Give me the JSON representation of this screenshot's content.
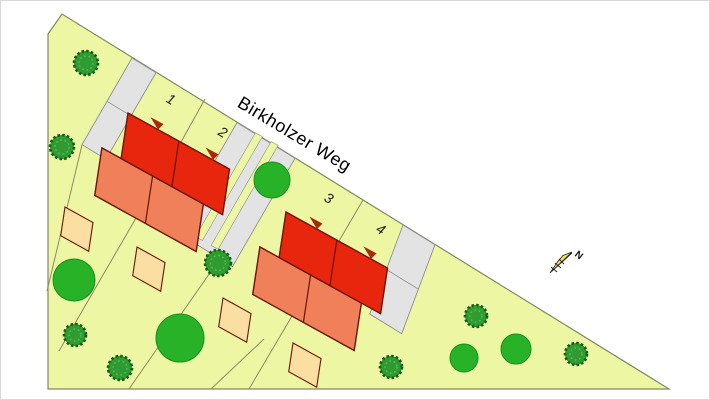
{
  "map": {
    "street": {
      "name": "Birkholzer Weg"
    },
    "plots": [
      {
        "label": "1"
      },
      {
        "label": "2"
      },
      {
        "label": "3"
      },
      {
        "label": "4"
      }
    ],
    "north": {
      "label": "N"
    },
    "colors": {
      "background": "#ffffff",
      "plot_green": "#edf6a3",
      "plot_border": "#85856a",
      "boundary_line": "#8b8b68",
      "driveway_gray": "#e3e3e3",
      "driveway_border": "#8f8f8f",
      "roof_red": "#e8260d",
      "house_salmon": "#f0805a",
      "terrace_peach": "#fbdfa2",
      "outline_dark": "#6b1400",
      "marker_red": "#a82808",
      "tree_green": "#28b228",
      "tree_stroke": "#179117",
      "tree_dark": "#2f9b30",
      "tree_tex_stroke": "#135c13",
      "tree_tex_light": "#57bb57",
      "north_yellow": "#f5e25c"
    }
  }
}
